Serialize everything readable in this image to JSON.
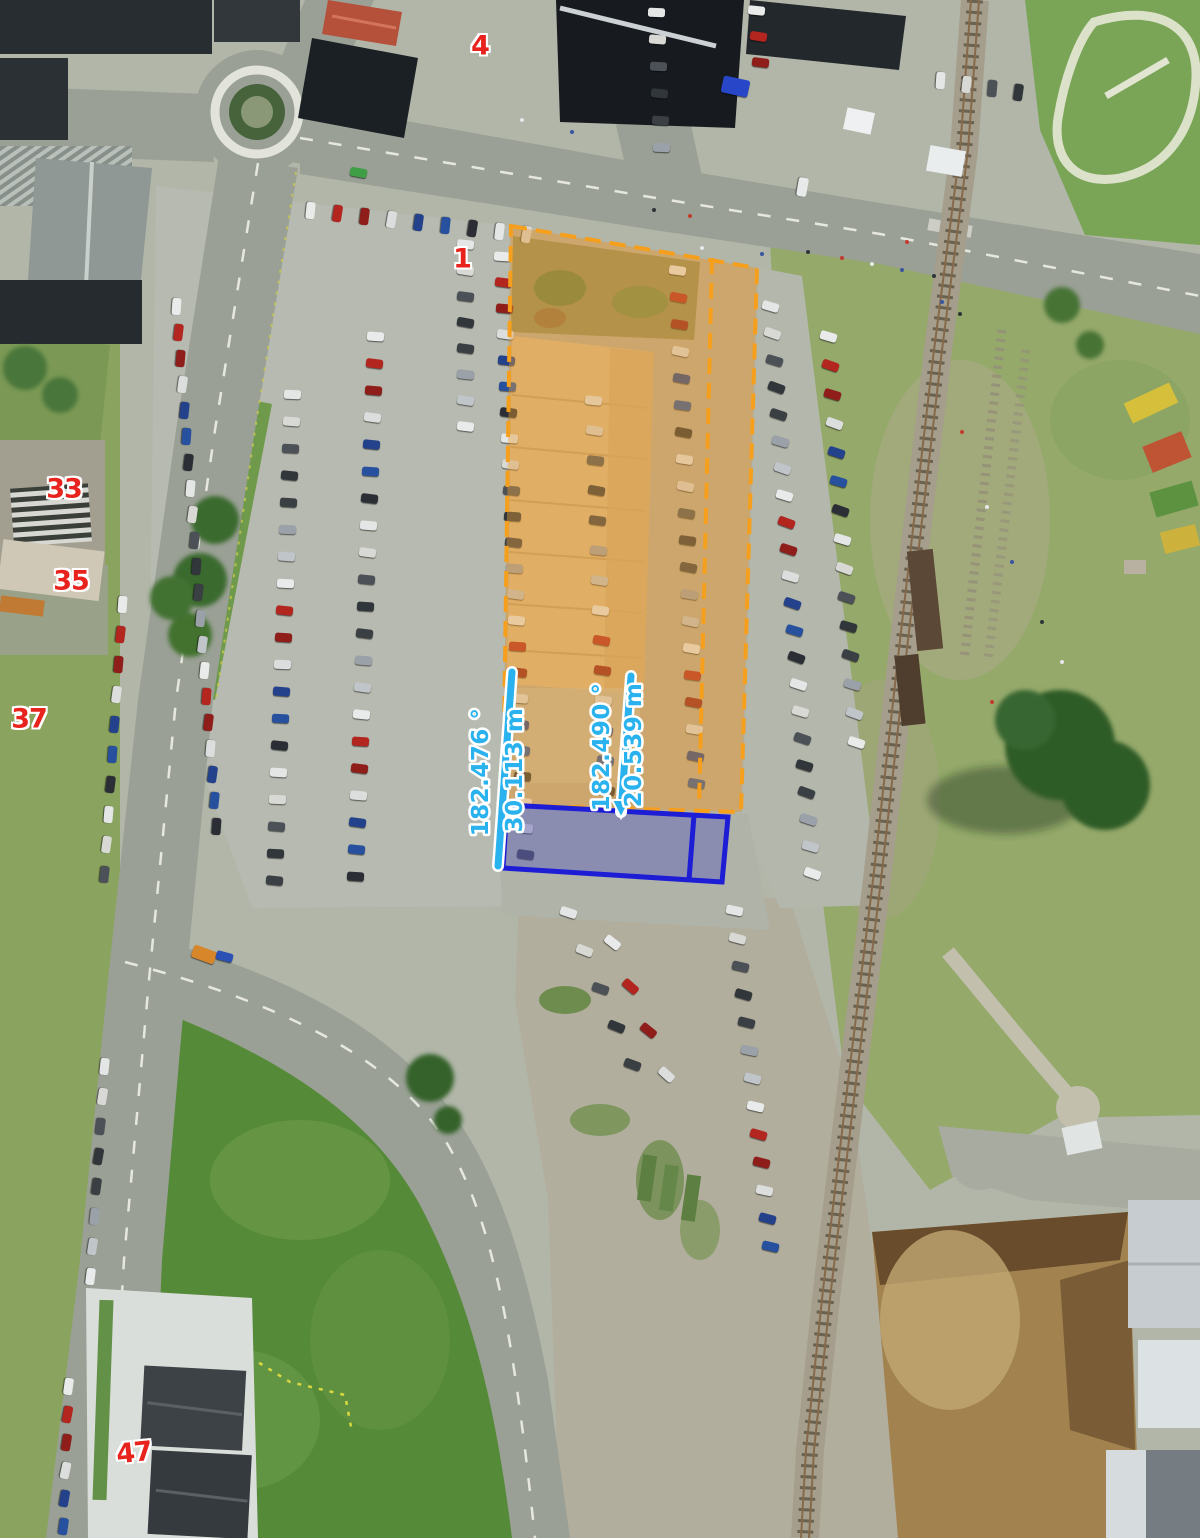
{
  "annotations": {
    "markers": [
      {
        "text": "4",
        "x": 480,
        "y": 46,
        "rot": 0
      },
      {
        "text": "1",
        "x": 462,
        "y": 259,
        "rot": 0
      },
      {
        "text": "33",
        "x": 64,
        "y": 489,
        "rot": 0
      },
      {
        "text": "35",
        "x": 71,
        "y": 581,
        "rot": 0
      },
      {
        "text": "37",
        "x": 29,
        "y": 719,
        "rot": 0
      },
      {
        "text": "47",
        "x": 134,
        "y": 1453,
        "rot": -6
      }
    ],
    "measurements": [
      {
        "bearing": "182.476 °",
        "length": "30.113 m"
      },
      {
        "bearing": "182.490 °",
        "length": "20.539 m"
      }
    ],
    "colors": {
      "measurement_text": "#29b2ee",
      "measurement_line": "#29b2ee",
      "marker_text": "#e8231d",
      "highlight_parcel_stroke": "#f59f1d",
      "highlight_parcel_fill": "rgba(233,158,52,0.42)",
      "selected_parcel_stroke": "#1d1dd6",
      "selected_parcel_fill": "rgba(76,76,190,0.36)"
    }
  }
}
